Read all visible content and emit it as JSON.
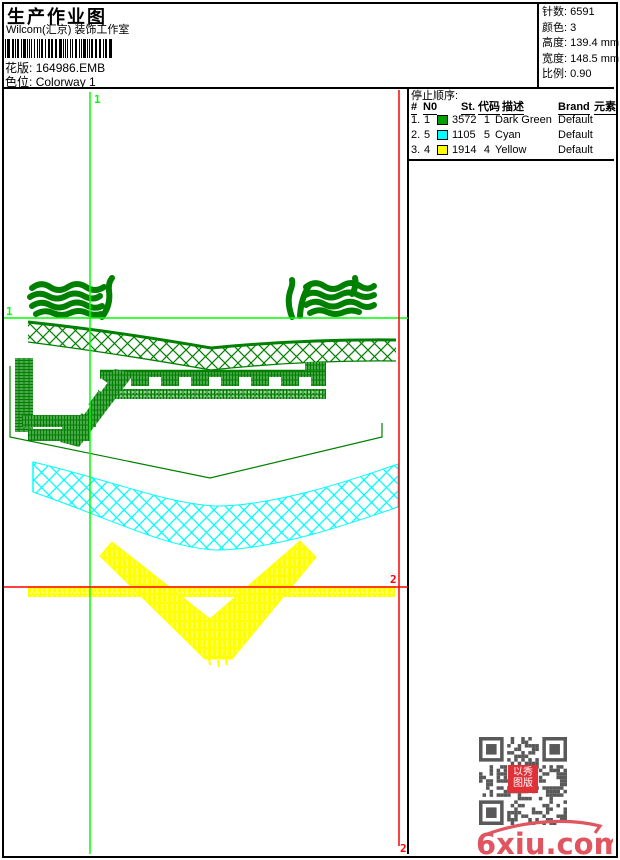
{
  "header": {
    "title": "生产作业图",
    "subtitle": "Wilcom(汇京) 装饰工作室",
    "pattern_label": "花版:",
    "pattern_value": "164986.EMB",
    "colorway_label": "色位:",
    "colorway_value": "Colorway 1"
  },
  "info": {
    "stitches_label": "针数:",
    "stitches_value": "6591",
    "colors_label": "颜色:",
    "colors_value": "3",
    "height_label": "高度:",
    "height_value": "139.4 mm",
    "width_label": "宽度:",
    "width_value": "148.5 mm",
    "scale_label": "比例:",
    "scale_value": "0.90"
  },
  "stop_table": {
    "title": "停止顺序:",
    "headers": {
      "num": "#",
      "n0": "N0",
      "st": "St.",
      "code": "代码",
      "desc": "描述",
      "brand": "Brand",
      "elem": "元素"
    },
    "rows": [
      {
        "num": "1.",
        "n0": "1",
        "color": "#00A000",
        "st": "3572",
        "code": "1",
        "desc": "Dark Green",
        "brand": "Default",
        "elem": ""
      },
      {
        "num": "2.",
        "n0": "5",
        "color": "#00FFFF",
        "st": "1105",
        "code": "5",
        "desc": "Cyan",
        "brand": "Default",
        "elem": ""
      },
      {
        "num": "3.",
        "n0": "4",
        "color": "#FFFF00",
        "st": "1914",
        "code": "4",
        "desc": "Yellow",
        "brand": "Default",
        "elem": ""
      }
    ]
  },
  "guides": {
    "green_v_label": "1",
    "green_h_label": "1",
    "red_h_label": "2",
    "red_v_label": "2"
  },
  "qr": {
    "seal_line1": "以秀",
    "seal_line2": "图版"
  },
  "watermark": {
    "text": "6xiu.com"
  },
  "design_colors": {
    "green": "#008000",
    "bright_green": "#00FF00",
    "cyan": "#00FFFF",
    "yellow": "#FFFF00",
    "red": "#FF0000",
    "watermark_red": "#E05560",
    "qr_gray": "#595959",
    "seal_red": "#E03038"
  }
}
